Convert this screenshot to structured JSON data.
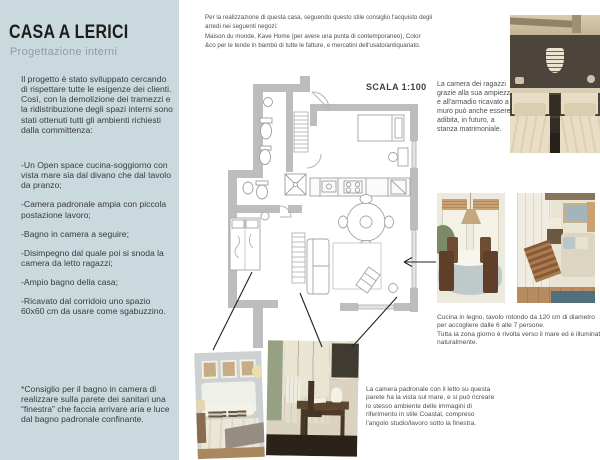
{
  "colors": {
    "sidebar_bg": "#c9d9dd",
    "text_dark": "#3b3b3b",
    "wall_gray": "#bdbdbd"
  },
  "sidebar": {
    "title": "CASA A LERICI",
    "subtitle": "Progettazione interni",
    "intro": "Il progetto è stato sviluppato cercando di rispettare tutte le esigenze dei clienti.\nCosì, con la demolizione dei tramezzi e la ridistribuzione degli spazi interni sono stati ottenuti tutti gli ambienti richiesti dalla committenza:",
    "bullets": [
      "-Un Open space cucina-soggiorno con vista mare sia dal divano che dal tavolo da pranzo;",
      "-Camera padronale ampia con piccola postazione lavoro;",
      "-Bagno in camera a seguire;",
      "-Disimpegno dal quale poi si snoda la camera da letto ragazzi;",
      "-Ampio bagno della casa;",
      "-Ricavato dal corridoio uno spazio 60x60 cm da usare come sgabuzzino."
    ],
    "footnote": "*Consiglio per il bagno in camera di realizzare sulla parete dei sanitari una “finestra” che faccia arrivare aria e luce dal bagno padronale confinante."
  },
  "top_note": "Per la realizzazione di questa casa, seguendo questo stile consiglio l'acquisto degli arredi nei seguenti negozi:\nMaison du monde, Kave Home (per avere una punta di contemporaneo), Color &co per le tende in bambù di tutte le fatture, e mercatini dell'usato/antiquariato.",
  "plan": {
    "scale_label": "SCALA 1:100"
  },
  "captions": {
    "kids_room": "La camera dei ragazzi grazie alla sua ampiezza e all'armadio ricavato a muro può anche essere adibita, in futuro, a stanza matrimoniale.",
    "kitchen": "Cucina in legno, tavolo rotondo da 120 cm di diametro per accogliere dalle 6 alle 7 persone.\nTutta la zona giorno è rivolta verso il mare ed è illuminata naturalmente.",
    "master": "La camera padronale con il letto su questa parete ha la vista sul mare, e si può ricreare lo stesso ambiente delle immagini di riferimento in stile Coastal, compreso l'angolo studio/lavoro sotto la finestra."
  },
  "photos": {
    "p1": "kids twin-bed bedroom reference",
    "p2": "wooden dining / cucina reference",
    "p3": "coastal living corner reference",
    "p4": "master bedroom reference",
    "p5": "study desk corner reference"
  }
}
